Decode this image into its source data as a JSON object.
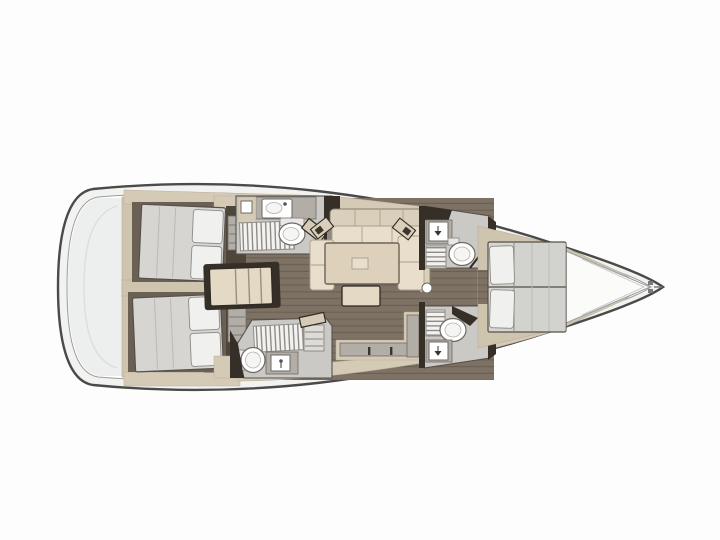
{
  "canvas": {
    "width": 720,
    "height": 540
  },
  "colors": {
    "page_bg": "#fdfdfd",
    "hull_line": "#4a4a4a",
    "deck_ring": "#f2f2f1",
    "inner_line": "#9c9c9c",
    "deck_white": "#ffffff",
    "platform": "#edeeee",
    "floor": "#7e7265",
    "floor_line": "#6b6055",
    "wood_dark": "#4e463a",
    "cabinet": "#d5cab6",
    "cabinet_mid": "#cfc4ae",
    "counter": "#b2aea7",
    "wet_room": "#cbc9c5",
    "fixture": "#ffffff",
    "grate_slat": "#f3f2f0",
    "grate_line": "#8f8c86",
    "mattress": "#d6d5d2",
    "mattress_seam": "#bab9b5",
    "pillow": "#f0f0ee",
    "sofa_back": "#d9cfba",
    "sofa_seat": "#e8decb",
    "table": "#ddd1bb",
    "dark_wall": "#362f27",
    "outline": "#55504a",
    "bow_deck": "#fbfbfa",
    "recess": "#6a6154"
  },
  "plan": {
    "type": "sailboat-interior-floor-plan",
    "orientation": "bow-right-stern-left",
    "areas": [
      {
        "name": "swim-platform"
      },
      {
        "name": "aft-cabin-port",
        "features": [
          "double-berth",
          "two-pillows",
          "locker",
          "walkway"
        ]
      },
      {
        "name": "aft-cabin-starboard",
        "features": [
          "double-berth",
          "two-pillows",
          "locker",
          "walkway"
        ]
      },
      {
        "name": "companionway-steps"
      },
      {
        "name": "aft-head-port",
        "features": [
          "sink",
          "vanity-cabinet",
          "shower-grate",
          "toilet",
          "door"
        ]
      },
      {
        "name": "aft-head-starboard",
        "features": [
          "sink",
          "shower-grate",
          "toilet",
          "door"
        ]
      },
      {
        "name": "salon",
        "features": [
          "u-shaped-settee",
          "dining-table",
          "bench-seat",
          "two-reading-lamps"
        ]
      },
      {
        "name": "galley-counter",
        "features": [
          "l-shaped-counter",
          "drawer-handles"
        ]
      },
      {
        "name": "forward-head-port",
        "features": [
          "sink",
          "shower-grate",
          "toilet"
        ]
      },
      {
        "name": "forward-head-starboard",
        "features": [
          "sink",
          "shower-grate",
          "toilet"
        ]
      },
      {
        "name": "forward-cabin",
        "features": [
          "island-double-berth",
          "two-pillows"
        ]
      },
      {
        "name": "bow-sail-locker"
      },
      {
        "name": "mast-post"
      }
    ]
  }
}
